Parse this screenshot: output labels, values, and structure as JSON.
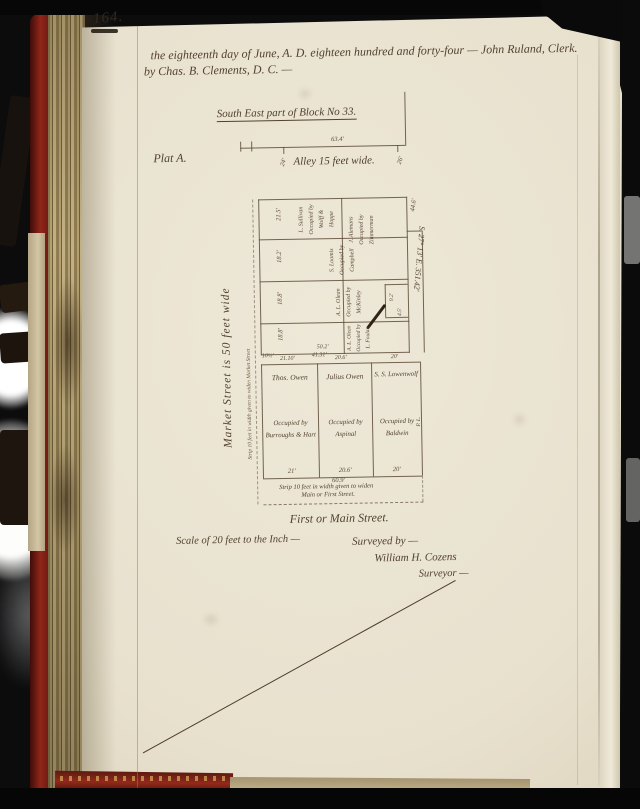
{
  "book": {
    "page_number": "164."
  },
  "header": {
    "line1": "the eighteenth day of June, A. D. eighteen hundred and forty-four — John Ruland, Clerk.",
    "line2": "by Chas. B. Clements, D. C. —"
  },
  "plat": {
    "title": "South East part of Block No 33.",
    "plat_label": "Plat A.",
    "alley_label": "Alley 15 feet wide.",
    "alley_width_marks": [
      "24'",
      "26'"
    ],
    "block_top_measure": "63.4'",
    "bearing": "S. 27° 13' E.  351.42'",
    "market_street_label": "Market Street is 50 feet wide",
    "market_strip_note": "Strip 10 feet in width given to widen Market Street",
    "upper_lots": [
      {
        "lines": [
          "L. Sullivan",
          "Occupied by",
          "Wolff & Hoppe"
        ]
      },
      {
        "lines": [
          "J. Alemans",
          "Occupied by",
          "Zimmerman"
        ]
      },
      {
        "lines": [
          "S. Loomis",
          "Occupied by",
          "Campbell"
        ]
      },
      {
        "lines": [
          "A. L. Olean",
          "Occupied by",
          "McKinley"
        ]
      },
      {
        "lines": [
          "A. L. Olean",
          "Occupied by",
          "L. Foulan"
        ]
      }
    ],
    "upper_left_measures": [
      "21.5'",
      "18.2'",
      "18.8'",
      "18.8'"
    ],
    "upper_right_measure": "44.6'",
    "notch_measures": [
      "9.2'",
      "4.5'"
    ],
    "mid_measures": [
      "10½'",
      "50.2'",
      "41.31'"
    ],
    "lower_top_measures": [
      "21.10'",
      "20.6'",
      "20'"
    ],
    "lower_lots": [
      {
        "name": "Thos. Owen",
        "occ1": "Occupied by",
        "occ2": "Burroughs & Hart",
        "width": "21'"
      },
      {
        "name": "Julius Owen",
        "occ1": "Occupied by",
        "occ2": "Aspinal",
        "width": "20.6'"
      },
      {
        "name": "S. S. Lowenwolf",
        "occ1": "Occupied by",
        "occ2": "Baldwin",
        "width": "20'"
      }
    ],
    "frontage_total": "60.9'",
    "corner_mark": "P. L.",
    "strip_note_line1": "Strip 10 feet in width given to widen",
    "strip_note_line2": "Main or First Street.",
    "street_label": "First or Main Street.",
    "scale_label": "Scale of 20 feet to the Inch —",
    "surveyed_by": "Surveyed by —",
    "surveyor_name": "William H. Cozens",
    "surveyor_title": "Surveyor —"
  },
  "colors": {
    "ink": "#52412e",
    "page": "#e9e3d1",
    "spine_red": "#8a241a",
    "page_edge_tan": "#b5a171",
    "margin_line": "#b96a5e"
  }
}
